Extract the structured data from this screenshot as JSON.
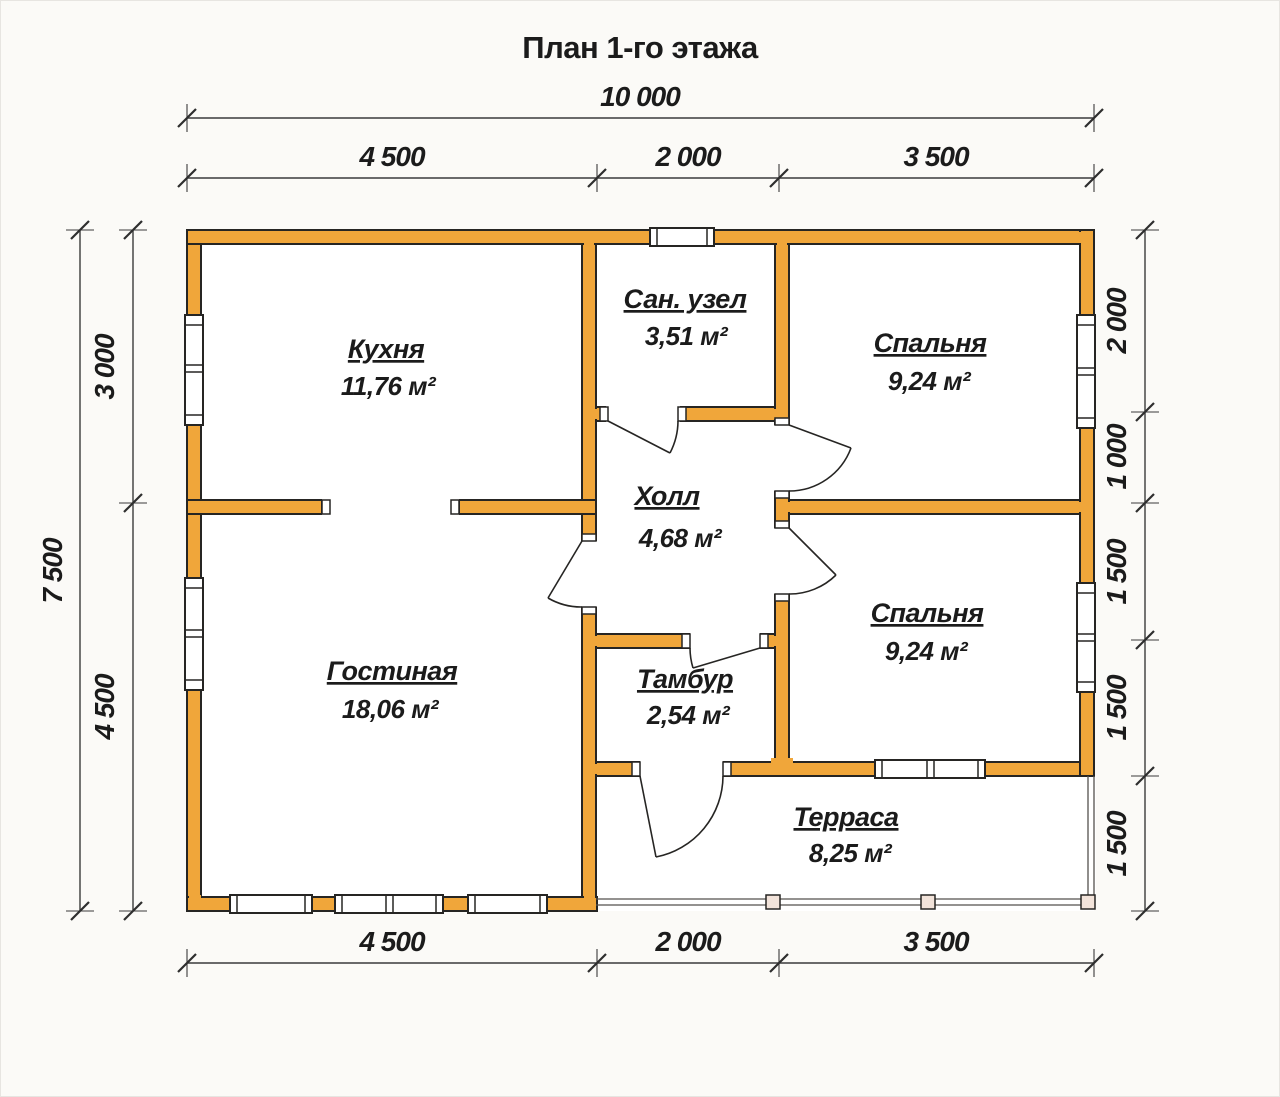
{
  "title": "План 1-го этажа",
  "colors": {
    "wall_fill": "#F0A63A",
    "outline": "#262523",
    "background": "#FBFAF7",
    "room_floor": "#FFFFFF",
    "terrace_post": "#F2E3DA",
    "dimension_line": "#3B3B3B",
    "text": "#1B1B1B"
  },
  "rooms": [
    {
      "id": "kitchen",
      "name": "Кухня",
      "area": "11,76 м²"
    },
    {
      "id": "bathroom",
      "name": "Сан. узел",
      "area": "3,51 м²"
    },
    {
      "id": "bedroom1",
      "name": "Спальня",
      "area": "9,24 м²"
    },
    {
      "id": "hall",
      "name": "Холл",
      "area": "4,68 м²"
    },
    {
      "id": "bedroom2",
      "name": "Спальня",
      "area": "9,24 м²"
    },
    {
      "id": "living",
      "name": "Гостиная",
      "area": "18,06 м²"
    },
    {
      "id": "vestibule",
      "name": "Тамбур",
      "area": "2,54 м²"
    },
    {
      "id": "terrace",
      "name": "Терраса",
      "area": "8,25 м²"
    }
  ],
  "dimensions": {
    "top_total": "10 000",
    "top_segments": [
      "4 500",
      "2 000",
      "3 500"
    ],
    "bottom_segments": [
      "4 500",
      "2 000",
      "3 500"
    ],
    "left_total": "7 500",
    "left_segments": [
      "3 000",
      "4 500"
    ],
    "right_segments": [
      "2 000",
      "1 000",
      "1 500",
      "1 500",
      "1 500"
    ]
  }
}
